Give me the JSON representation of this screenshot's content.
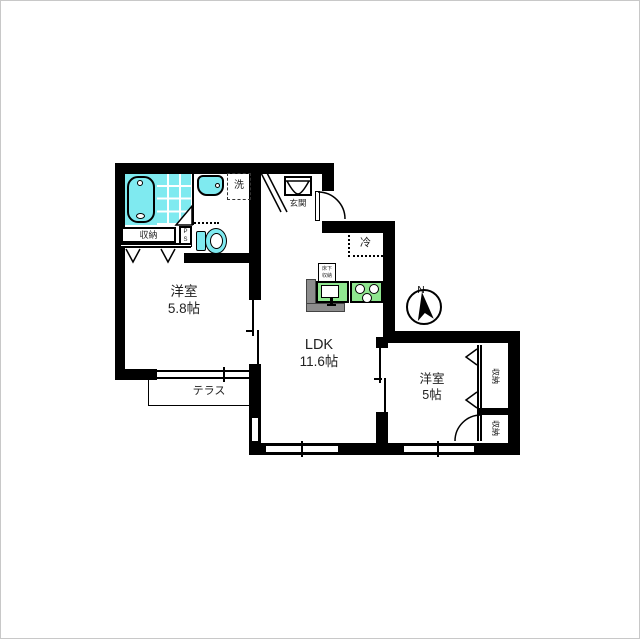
{
  "plan": {
    "rooms": {
      "western1": {
        "name": "洋室",
        "size": "5.8帖"
      },
      "ldk": {
        "name": "LDK",
        "size": "11.6帖"
      },
      "western2": {
        "name": "洋室",
        "size": "5帖"
      }
    },
    "labels": {
      "terrace": "テラス",
      "entrance": "玄関",
      "laundry": "洗",
      "refrigerator": "冷",
      "closet": "収納",
      "closet_right_top": "収納",
      "closet_right_bottom": "収納",
      "pipe_space_p": "P",
      "pipe_space_s": "S",
      "underfloor_storage_line1": "床下",
      "underfloor_storage_line2": "収納"
    },
    "compass": {
      "north": "N"
    },
    "colors": {
      "wall": "#000000",
      "water_fixture": "#7feaf0",
      "kitchen_counter": "#8fe68f",
      "counter_edge": "#8d8d8d"
    }
  }
}
